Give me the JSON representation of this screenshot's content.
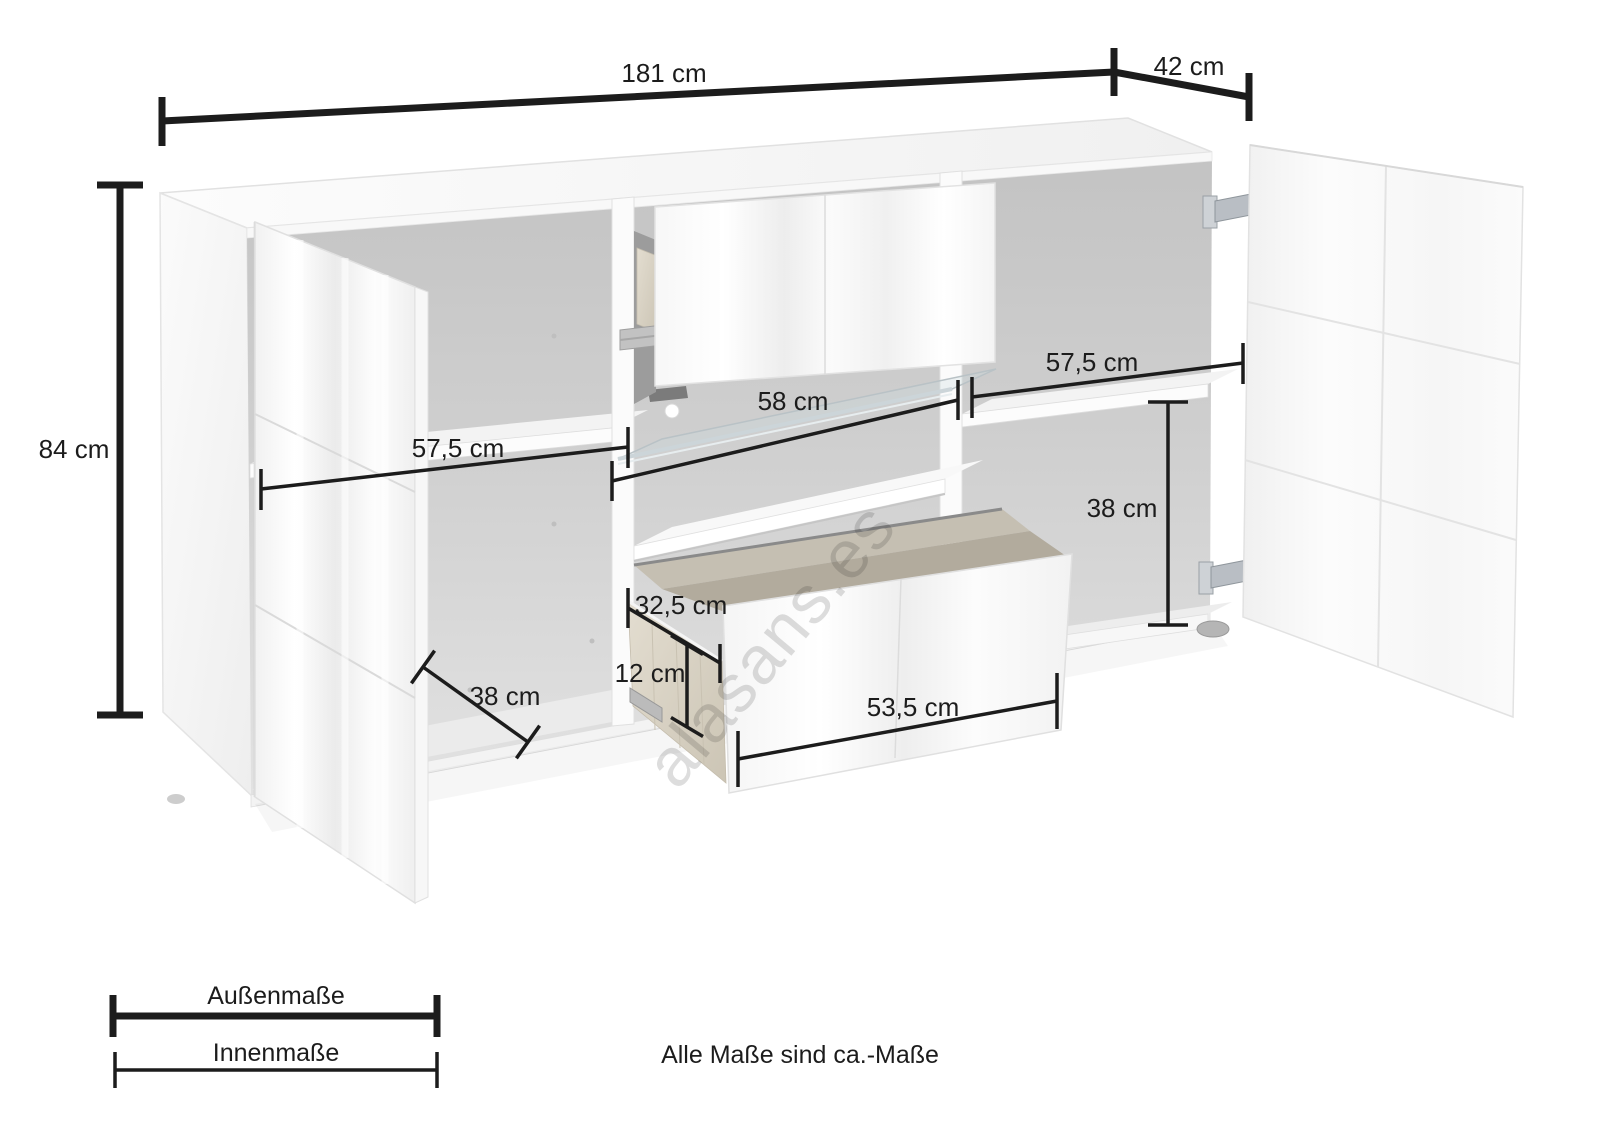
{
  "diagram": {
    "title": "sideboard-dimension-drawing",
    "measurements": {
      "width_total": "181 cm",
      "depth_total": "42 cm",
      "height_total": "84 cm",
      "left_inner_width": "57,5 cm",
      "middle_inner_width": "58 cm",
      "right_inner_width": "57,5 cm",
      "right_inner_height": "38 cm",
      "left_inner_depth": "38 cm",
      "drawer_inner_depth": "32,5 cm",
      "drawer_inner_height": "12 cm",
      "drawer_inner_width": "53,5 cm"
    },
    "legend": {
      "outer_label": "Außenmaße",
      "inner_label": "Innenmaße"
    },
    "footnote": "Alle Maße sind ca.-Maße",
    "watermark": "alasans.es",
    "colors": {
      "dimension_line": "#1c1c1c",
      "cabinet_white": "#ffffff",
      "interior_gray": "#c9c9c9",
      "wood_texture": "#d9d3c6",
      "hinge_metal": "#c5c9cd"
    }
  }
}
